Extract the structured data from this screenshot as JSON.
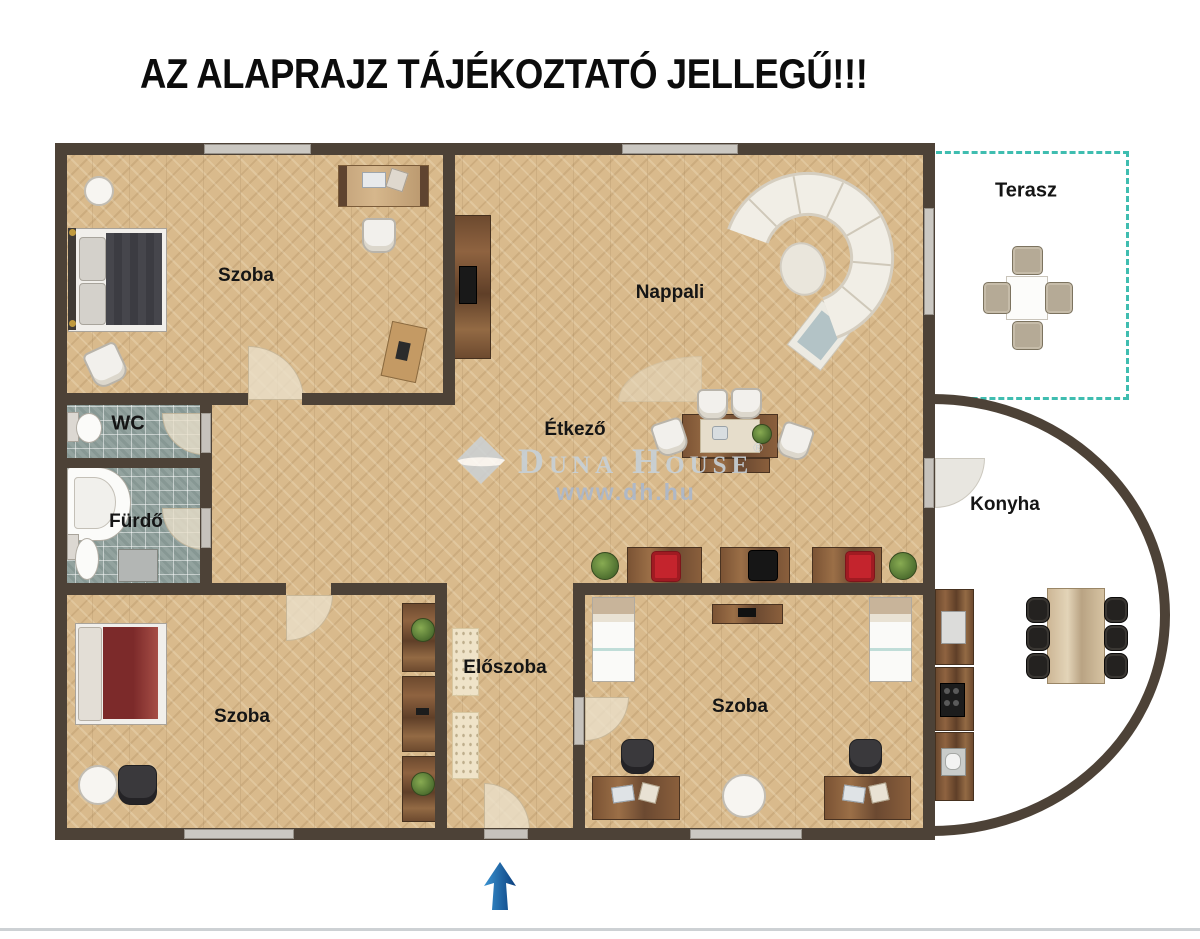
{
  "title": "AZ ALAPRAJZ TÁJÉKOZTATÓ JELLEGŰ!!!",
  "rooms": {
    "szoba_top": {
      "label": "Szoba"
    },
    "nappali": {
      "label": "Nappali"
    },
    "etkezo": {
      "label": "Étkező"
    },
    "wc": {
      "label": "WC"
    },
    "furdo": {
      "label": "Fürdő"
    },
    "eloszoba": {
      "label": "Előszoba"
    },
    "szoba_bottom_left": {
      "label": "Szoba"
    },
    "szoba_bottom_right": {
      "label": "Szoba"
    },
    "konyha": {
      "label": "Konyha"
    },
    "terasz": {
      "label": "Terasz"
    }
  },
  "watermark": {
    "brand": "Duna House",
    "registered": "®",
    "url": "www.dh.hu"
  },
  "icons": {
    "north_arrow": "↑"
  },
  "colors": {
    "wall": "#4d4237",
    "wood_floor": "#d9ba8c",
    "tile_floor": "#93a39f",
    "terrace_dash": "#3fbdb0",
    "north_arrow_blue": "#1a63a8",
    "red_chair": "#c4242d"
  }
}
